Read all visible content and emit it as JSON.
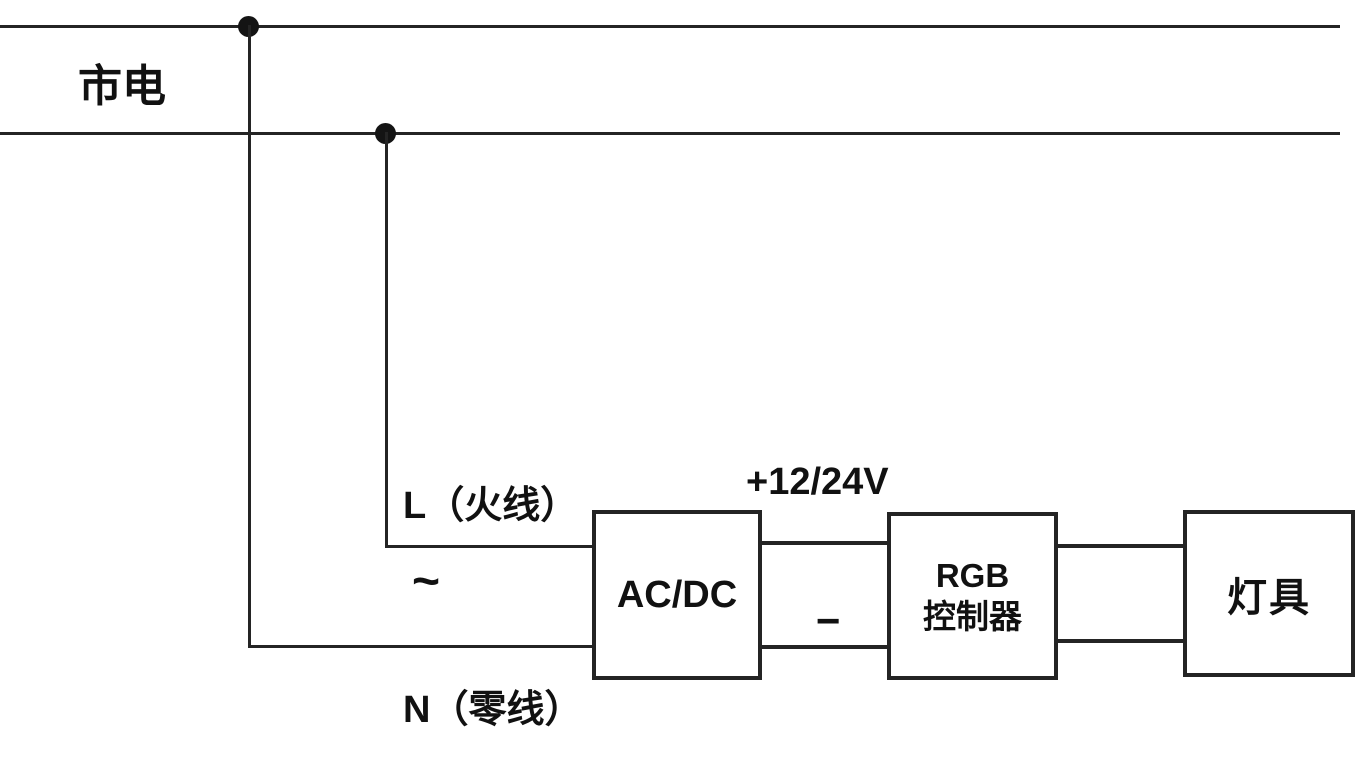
{
  "diagram": {
    "title": "mains to AC/DC to RGB controller to lamp wiring diagram",
    "mains_label": "市电",
    "live_label": "L（火线）",
    "ac_symbol": "~",
    "neutral_label": "N（零线）",
    "voltage_label": "+12/24V",
    "negative_label": "−",
    "boxes": {
      "acdc": "AC/DC",
      "rgb_controller": "RGB\n控制器",
      "lamp": "灯具"
    },
    "colors": {
      "wire": "#242424",
      "dot": "#141414",
      "text": "#111111",
      "background": "#ffffff"
    }
  }
}
